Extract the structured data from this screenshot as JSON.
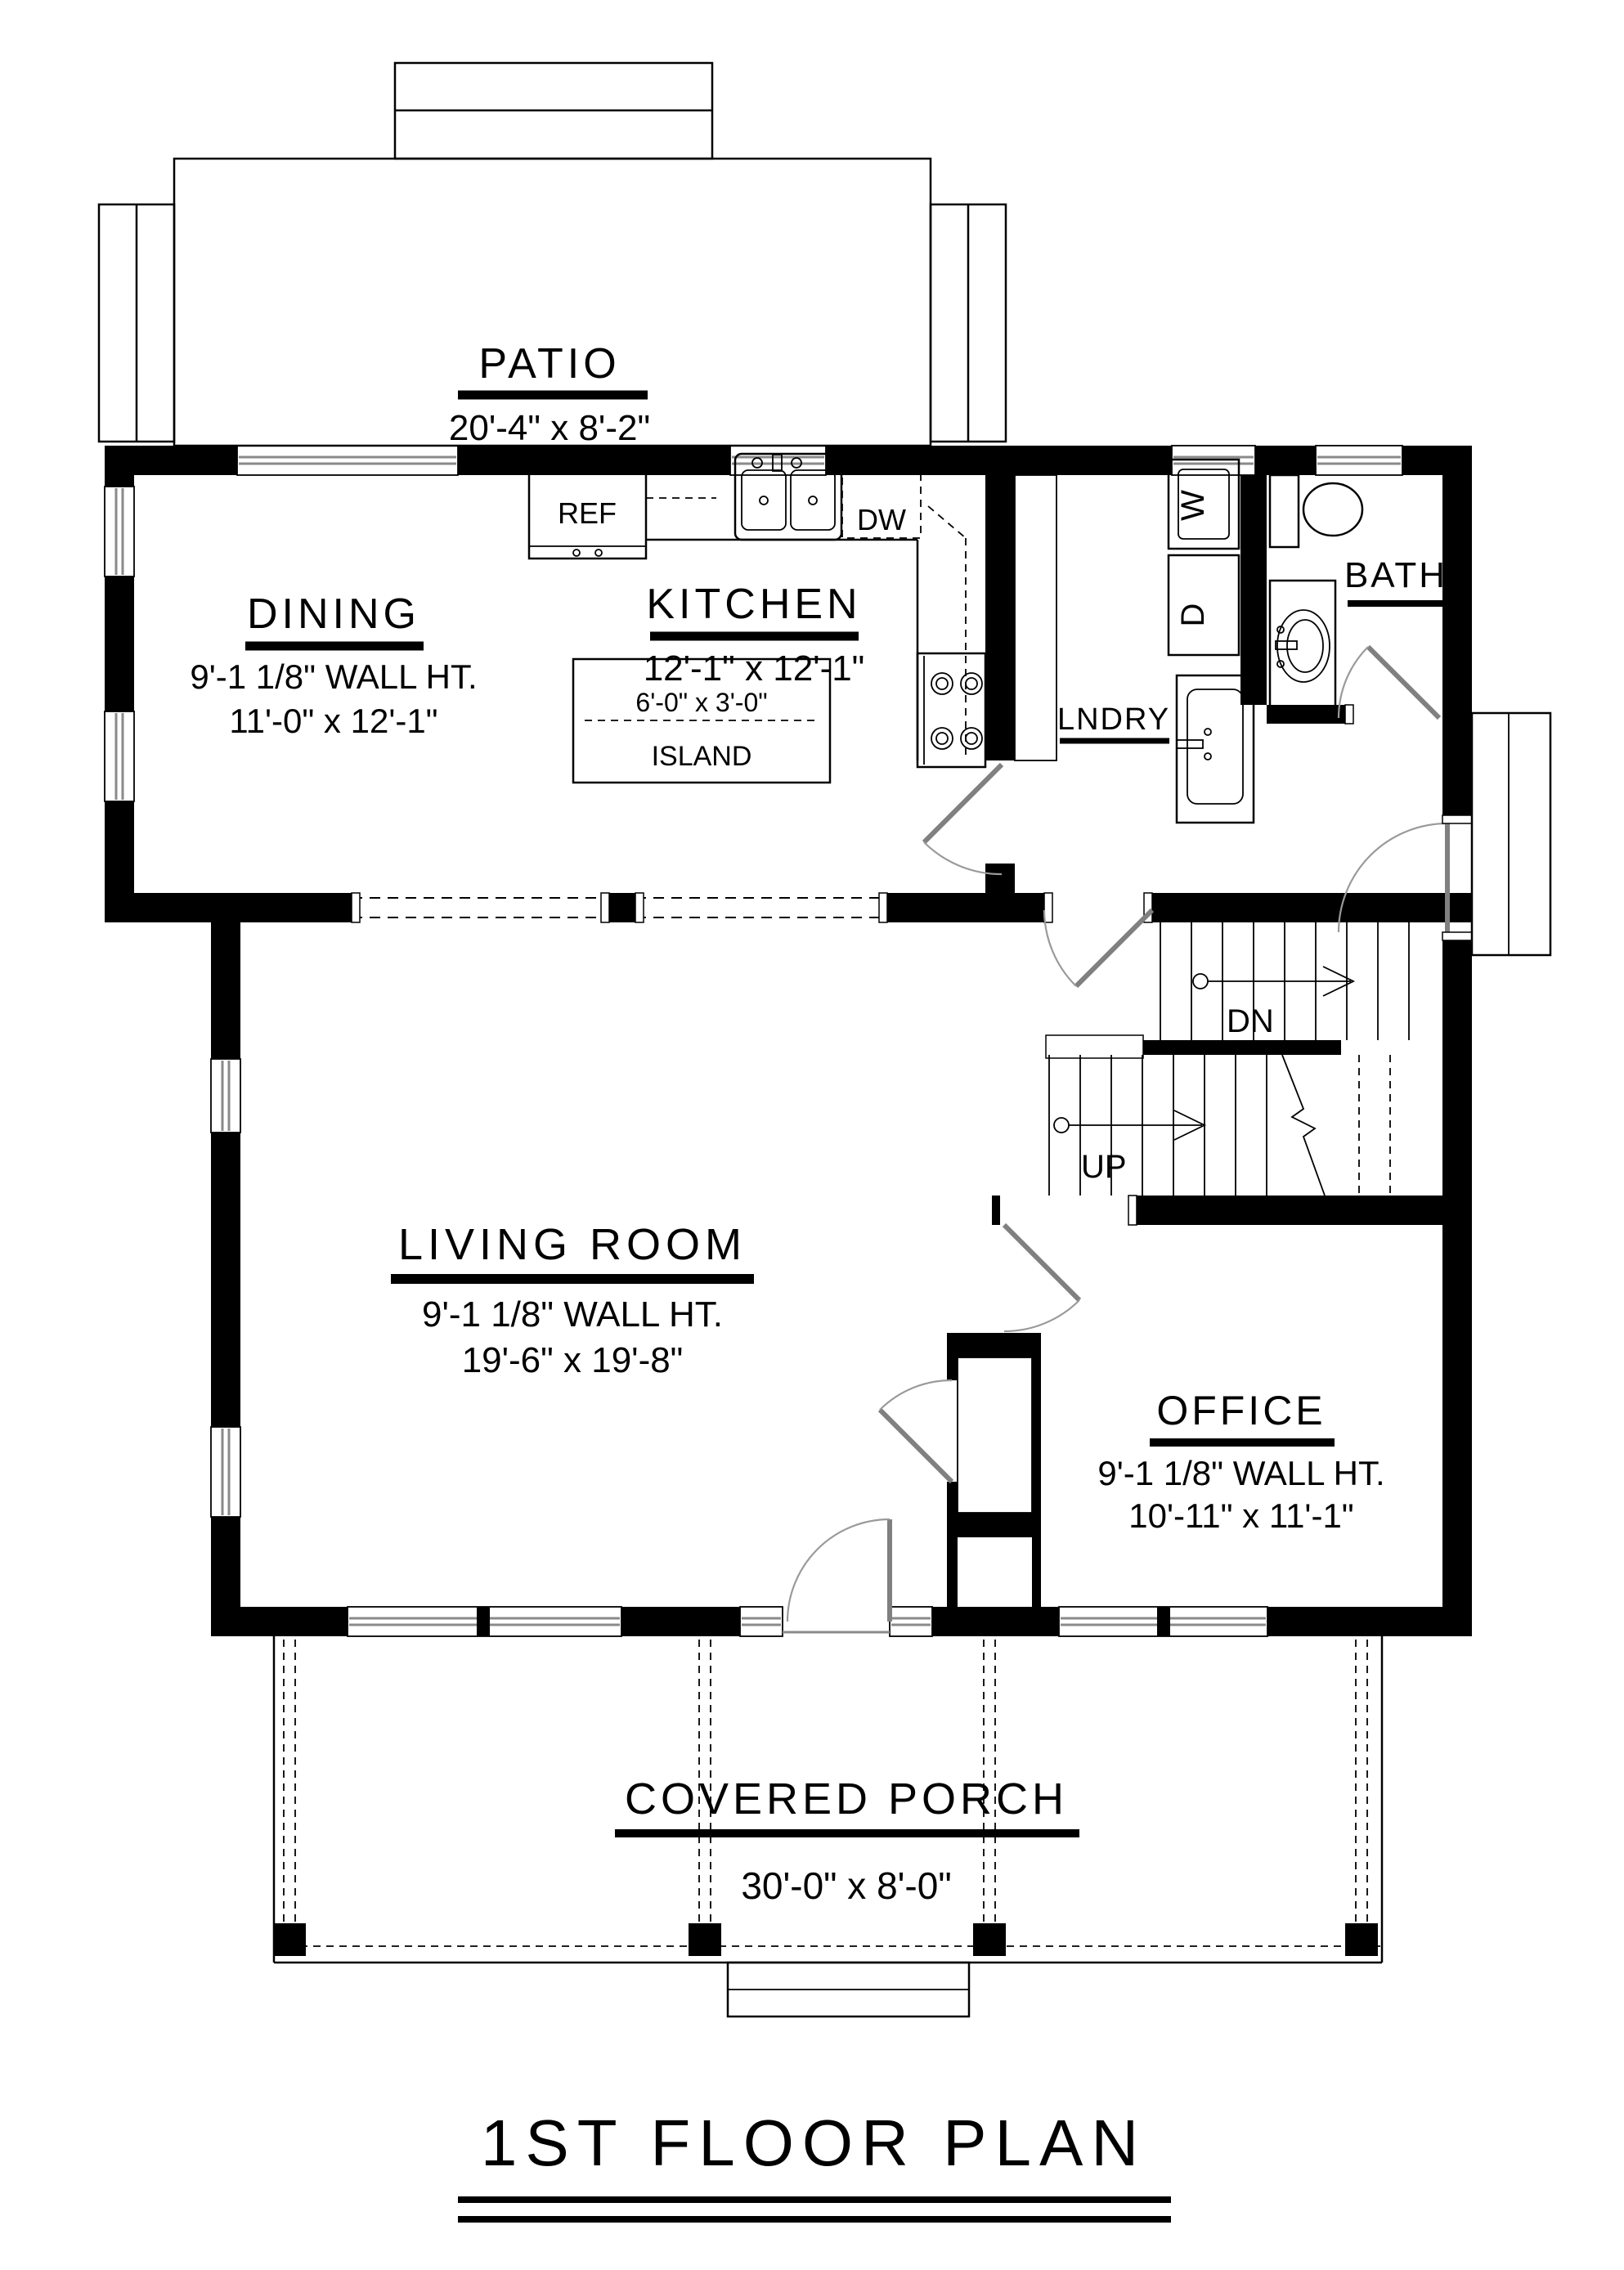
{
  "title": "1ST FLOOR PLAN",
  "rooms": {
    "patio": {
      "name": "PATIO",
      "dims": "20'-4\" x 8'-2\""
    },
    "dining": {
      "name": "DINING",
      "wall_ht": "9'-1 1/8\" WALL HT.",
      "dims": "11'-0\" x 12'-1\""
    },
    "kitchen": {
      "name": "KITCHEN",
      "dims": "12'-1\" x 12'-1\""
    },
    "island": {
      "dims": "6'-0\" x 3'-0\"",
      "name": "ISLAND"
    },
    "laundry": {
      "name": "LNDRY"
    },
    "bath": {
      "name": "BATH"
    },
    "living": {
      "name": "LIVING ROOM",
      "wall_ht": "9'-1 1/8\" WALL HT.",
      "dims": "19'-6\" x 19'-8\""
    },
    "office": {
      "name": "OFFICE",
      "wall_ht": "9'-1 1/8\" WALL HT.",
      "dims": "10'-11\" x 11'-1\""
    },
    "porch": {
      "name": "COVERED PORCH",
      "dims": "30'-0\" x 8'-0\""
    }
  },
  "appliances": {
    "ref": "REF",
    "dw": "DW",
    "washer": "W",
    "dryer": "D"
  },
  "stairs": {
    "dn": "DN",
    "up": "UP"
  }
}
